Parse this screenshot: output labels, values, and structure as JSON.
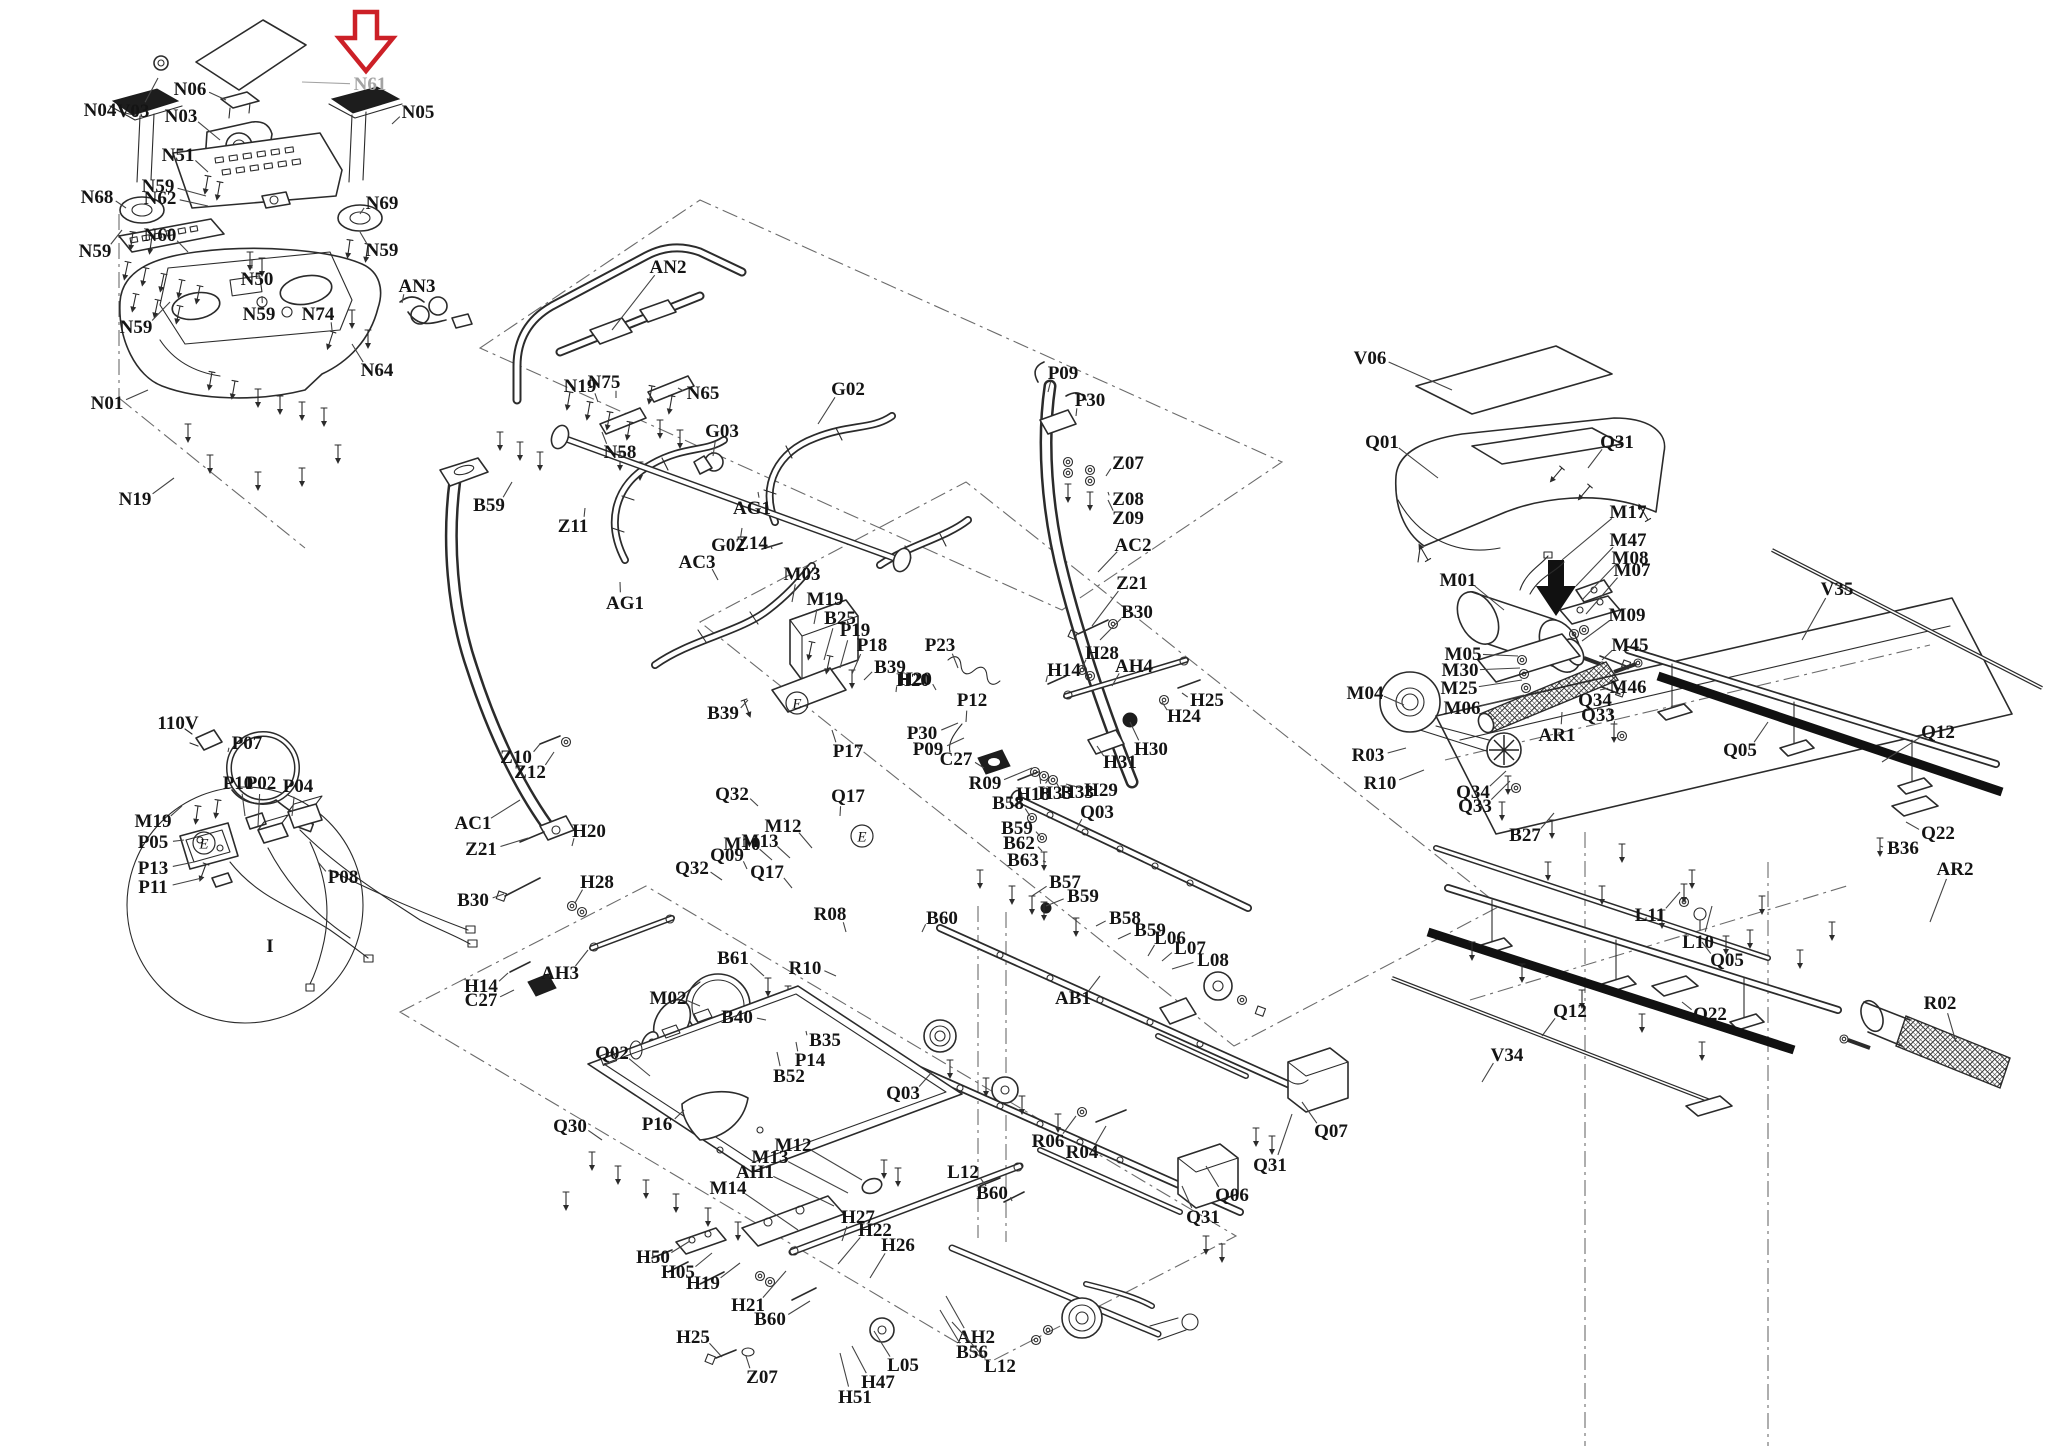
{
  "page": {
    "type": "exploded-parts-diagram",
    "subject": "treadmill-parts-schematic",
    "background": "#ffffff"
  },
  "style": {
    "line": "#2b2b2b",
    "label": "#141414",
    "leader": "#444444",
    "muted_label": "#a3a3a3",
    "highlight": "#cc2027"
  },
  "highlight_arrow": {
    "shape": "down-arrow-outline",
    "target_label": "N61"
  },
  "secondary_arrow": {
    "shape": "down-arrow-solid",
    "color": "#111111"
  },
  "circled_marks": [
    {
      "t": "E",
      "x": 204,
      "y": 843
    },
    {
      "t": "E",
      "x": 797,
      "y": 703
    },
    {
      "t": "E",
      "x": 862,
      "y": 836
    }
  ],
  "labels": [
    {
      "t": "N04",
      "x": 100,
      "y": 110,
      "ex": 138,
      "ey": 116
    },
    {
      "t": "V03",
      "x": 133,
      "y": 111,
      "ex": 158,
      "ey": 78
    },
    {
      "t": "N06",
      "x": 190,
      "y": 89,
      "ex": 226,
      "ey": 100
    },
    {
      "t": "N03",
      "x": 181,
      "y": 116,
      "ex": 220,
      "ey": 140
    },
    {
      "t": "N51",
      "x": 178,
      "y": 155,
      "ex": 208,
      "ey": 172
    },
    {
      "t": "N59",
      "x": 158,
      "y": 186,
      "ex": 206,
      "ey": 196
    },
    {
      "t": "N62",
      "x": 160,
      "y": 198,
      "ex": 208,
      "ey": 206
    },
    {
      "t": "N68",
      "x": 97,
      "y": 197,
      "ex": 126,
      "ey": 208
    },
    {
      "t": "N59",
      "x": 95,
      "y": 251,
      "ex": 122,
      "ey": 230
    },
    {
      "t": "N60",
      "x": 160,
      "y": 235,
      "ex": 188,
      "ey": 252
    },
    {
      "t": "N50",
      "x": 257,
      "y": 279,
      "ex": 252,
      "ey": 260
    },
    {
      "t": "N69",
      "x": 382,
      "y": 203,
      "ex": 360,
      "ey": 214
    },
    {
      "t": "N59",
      "x": 382,
      "y": 250,
      "ex": 360,
      "ey": 232
    },
    {
      "t": "N05",
      "x": 418,
      "y": 112,
      "ex": 392,
      "ey": 124
    },
    {
      "t": "N61",
      "x": 370,
      "y": 84,
      "ex": 302,
      "ey": 82,
      "m": 1
    },
    {
      "t": "AN3",
      "x": 417,
      "y": 286,
      "ex": 402,
      "ey": 303
    },
    {
      "t": "N74",
      "x": 318,
      "y": 314,
      "ex": 332,
      "ey": 330
    },
    {
      "t": "N64",
      "x": 377,
      "y": 370,
      "ex": 352,
      "ey": 344
    },
    {
      "t": "N59",
      "x": 259,
      "y": 314,
      "ex": 262,
      "ey": 296
    },
    {
      "t": "N59",
      "x": 136,
      "y": 327,
      "ex": 170,
      "ey": 302
    },
    {
      "t": "N01",
      "x": 107,
      "y": 403,
      "ex": 148,
      "ey": 390
    },
    {
      "t": "N19",
      "x": 135,
      "y": 499,
      "ex": 174,
      "ey": 478
    },
    {
      "t": "110V",
      "x": 178,
      "y": 723,
      "b": 1
    },
    {
      "t": "P07",
      "x": 247,
      "y": 743,
      "ex": 228,
      "ey": 752
    },
    {
      "t": "P10",
      "x": 238,
      "y": 783,
      "ex": 245,
      "ey": 816
    },
    {
      "t": "P02",
      "x": 261,
      "y": 783,
      "ex": 258,
      "ey": 826
    },
    {
      "t": "P04",
      "x": 298,
      "y": 786,
      "ex": 292,
      "ey": 816
    },
    {
      "t": "M19",
      "x": 153,
      "y": 821,
      "ex": 182,
      "ey": 806
    },
    {
      "t": "P05",
      "x": 153,
      "y": 842,
      "ex": 184,
      "ey": 840
    },
    {
      "t": "P13",
      "x": 153,
      "y": 868,
      "ex": 194,
      "ey": 862
    },
    {
      "t": "P11",
      "x": 153,
      "y": 887,
      "ex": 202,
      "ey": 878
    },
    {
      "t": "P08",
      "x": 343,
      "y": 877,
      "ex": 318,
      "ey": 862
    },
    {
      "t": "I",
      "x": 270,
      "y": 946
    },
    {
      "t": "AN2",
      "x": 668,
      "y": 267,
      "ex": 612,
      "ey": 330
    },
    {
      "t": "N19",
      "x": 580,
      "y": 386,
      "ex": 598,
      "ey": 402
    },
    {
      "t": "N75",
      "x": 604,
      "y": 382,
      "ex": 616,
      "ey": 398
    },
    {
      "t": "N65",
      "x": 703,
      "y": 393,
      "ex": 678,
      "ey": 388
    },
    {
      "t": "N58",
      "x": 620,
      "y": 452,
      "ex": 602,
      "ey": 432
    },
    {
      "t": "G02",
      "x": 848,
      "y": 389,
      "ex": 818,
      "ey": 424
    },
    {
      "t": "G03",
      "x": 722,
      "y": 431,
      "ex": 713,
      "ey": 456
    },
    {
      "t": "AG1",
      "x": 752,
      "y": 508,
      "ex": 758,
      "ey": 492
    },
    {
      "t": "B59",
      "x": 489,
      "y": 505,
      "ex": 512,
      "ey": 482
    },
    {
      "t": "Z11",
      "x": 573,
      "y": 526,
      "ex": 585,
      "ey": 508
    },
    {
      "t": "G02",
      "x": 728,
      "y": 545,
      "ex": 742,
      "ey": 528
    },
    {
      "t": "Z14",
      "x": 752,
      "y": 543,
      "ex": 772,
      "ey": 549
    },
    {
      "t": "AC3",
      "x": 697,
      "y": 562,
      "ex": 718,
      "ey": 580
    },
    {
      "t": "AG1",
      "x": 625,
      "y": 603,
      "ex": 620,
      "ey": 582
    },
    {
      "t": "M03",
      "x": 802,
      "y": 574,
      "ex": 792,
      "ey": 602
    },
    {
      "t": "M19",
      "x": 825,
      "y": 599,
      "ex": 814,
      "ey": 624
    },
    {
      "t": "B25",
      "x": 840,
      "y": 618,
      "ex": 824,
      "ey": 660
    },
    {
      "t": "P19",
      "x": 855,
      "y": 630,
      "ex": 840,
      "ey": 668
    },
    {
      "t": "P18",
      "x": 872,
      "y": 645,
      "ex": 852,
      "ey": 674
    },
    {
      "t": "B39",
      "x": 890,
      "y": 667,
      "ex": 864,
      "ey": 680
    },
    {
      "t": "H20",
      "x": 913,
      "y": 680,
      "ex": 896,
      "ey": 692
    },
    {
      "t": "B39",
      "x": 723,
      "y": 713,
      "ex": 748,
      "ey": 700
    },
    {
      "t": "Z10",
      "x": 516,
      "y": 757,
      "ex": 540,
      "ey": 744
    },
    {
      "t": "Z12",
      "x": 530,
      "y": 772,
      "ex": 554,
      "ey": 752
    },
    {
      "t": "P17",
      "x": 848,
      "y": 751,
      "ex": 832,
      "ey": 730
    },
    {
      "t": "P30",
      "x": 922,
      "y": 733,
      "ex": 958,
      "ey": 723
    },
    {
      "t": "P09",
      "x": 928,
      "y": 749,
      "ex": 964,
      "ey": 738
    },
    {
      "t": "AC1",
      "x": 473,
      "y": 823,
      "ex": 520,
      "ey": 800
    },
    {
      "t": "Z21",
      "x": 481,
      "y": 849,
      "ex": 528,
      "ey": 838
    },
    {
      "t": "H20",
      "x": 589,
      "y": 831,
      "ex": 572,
      "ey": 846
    },
    {
      "t": "B30",
      "x": 473,
      "y": 900,
      "ex": 504,
      "ey": 894
    },
    {
      "t": "H28",
      "x": 597,
      "y": 882,
      "ex": 575,
      "ey": 903
    },
    {
      "t": "AH3",
      "x": 560,
      "y": 973,
      "ex": 588,
      "ey": 950
    },
    {
      "t": "H14",
      "x": 481,
      "y": 986,
      "ex": 508,
      "ey": 973
    },
    {
      "t": "C27",
      "x": 481,
      "y": 1000,
      "ex": 514,
      "ey": 990
    },
    {
      "t": "Q32",
      "x": 732,
      "y": 794,
      "ex": 758,
      "ey": 806
    },
    {
      "t": "Q17",
      "x": 848,
      "y": 796,
      "ex": 840,
      "ey": 816
    },
    {
      "t": "Q32",
      "x": 692,
      "y": 868,
      "ex": 722,
      "ey": 880
    },
    {
      "t": "Q09",
      "x": 727,
      "y": 855,
      "ex": 747,
      "ey": 869
    },
    {
      "t": "M10",
      "x": 742,
      "y": 844,
      "ex": 772,
      "ey": 860
    },
    {
      "t": "M13",
      "x": 760,
      "y": 841,
      "ex": 790,
      "ey": 858
    },
    {
      "t": "M12",
      "x": 783,
      "y": 826,
      "ex": 812,
      "ey": 848
    },
    {
      "t": "Q17",
      "x": 767,
      "y": 872,
      "ex": 792,
      "ey": 888
    },
    {
      "t": "R08",
      "x": 830,
      "y": 914,
      "ex": 846,
      "ey": 932
    },
    {
      "t": "B60",
      "x": 942,
      "y": 918,
      "ex": 922,
      "ey": 932
    },
    {
      "t": "R10",
      "x": 805,
      "y": 968,
      "ex": 836,
      "ey": 976
    },
    {
      "t": "B61",
      "x": 733,
      "y": 958,
      "ex": 764,
      "ey": 976
    },
    {
      "t": "M02",
      "x": 668,
      "y": 998,
      "ex": 700,
      "ey": 1006
    },
    {
      "t": "B40",
      "x": 737,
      "y": 1017,
      "ex": 766,
      "ey": 1020
    },
    {
      "t": "B35",
      "x": 825,
      "y": 1040,
      "ex": 806,
      "ey": 1031
    },
    {
      "t": "P14",
      "x": 810,
      "y": 1060,
      "ex": 796,
      "ey": 1042
    },
    {
      "t": "B52",
      "x": 789,
      "y": 1076,
      "ex": 777,
      "ey": 1052
    },
    {
      "t": "Q02",
      "x": 612,
      "y": 1053,
      "ex": 650,
      "ey": 1076
    },
    {
      "t": "P16",
      "x": 657,
      "y": 1124,
      "ex": 684,
      "ey": 1110
    },
    {
      "t": "Q30",
      "x": 570,
      "y": 1126,
      "ex": 602,
      "ey": 1140
    },
    {
      "t": "Q03",
      "x": 903,
      "y": 1093,
      "ex": 932,
      "ey": 1072
    },
    {
      "t": "P09",
      "x": 1063,
      "y": 373,
      "ex": 1048,
      "ey": 392
    },
    {
      "t": "P30",
      "x": 1090,
      "y": 400,
      "ex": 1076,
      "ey": 416
    },
    {
      "t": "Z07",
      "x": 1128,
      "y": 463,
      "ex": 1106,
      "ey": 476
    },
    {
      "t": "Z08",
      "x": 1128,
      "y": 499,
      "ex": 1108,
      "ey": 492
    },
    {
      "t": "Z09",
      "x": 1128,
      "y": 518,
      "ex": 1108,
      "ey": 500
    },
    {
      "t": "AC2",
      "x": 1133,
      "y": 545,
      "ex": 1098,
      "ey": 572
    },
    {
      "t": "Z21",
      "x": 1132,
      "y": 583,
      "ex": 1092,
      "ey": 626
    },
    {
      "t": "B30",
      "x": 1137,
      "y": 612,
      "ex": 1100,
      "ey": 640
    },
    {
      "t": "H28",
      "x": 1102,
      "y": 653,
      "ex": 1082,
      "ey": 668
    },
    {
      "t": "H14",
      "x": 1064,
      "y": 670,
      "ex": 1046,
      "ey": 682
    },
    {
      "t": "AH4",
      "x": 1134,
      "y": 666,
      "ex": 1112,
      "ey": 686
    },
    {
      "t": "H25",
      "x": 1207,
      "y": 700,
      "ex": 1182,
      "ey": 693
    },
    {
      "t": "H24",
      "x": 1184,
      "y": 716,
      "ex": 1162,
      "ey": 702
    },
    {
      "t": "H30",
      "x": 1151,
      "y": 749,
      "ex": 1130,
      "ey": 722
    },
    {
      "t": "H31",
      "x": 1120,
      "y": 762,
      "ex": 1097,
      "ey": 746
    },
    {
      "t": "P23",
      "x": 940,
      "y": 645,
      "ex": 958,
      "ey": 668
    },
    {
      "t": "H20",
      "x": 915,
      "y": 679,
      "ex": 936,
      "ey": 690
    },
    {
      "t": "P12",
      "x": 972,
      "y": 700,
      "ex": 966,
      "ey": 722
    },
    {
      "t": "C27",
      "x": 956,
      "y": 759,
      "ex": 984,
      "ey": 768
    },
    {
      "t": "R09",
      "x": 985,
      "y": 783,
      "ex": 1032,
      "ey": 768
    },
    {
      "t": "H18",
      "x": 1033,
      "y": 794,
      "ex": 1040,
      "ey": 777
    },
    {
      "t": "H33",
      "x": 1055,
      "y": 793,
      "ex": 1048,
      "ey": 780
    },
    {
      "t": "H33",
      "x": 1077,
      "y": 792,
      "ex": 1056,
      "ey": 782
    },
    {
      "t": "H29",
      "x": 1101,
      "y": 790,
      "ex": 1066,
      "ey": 784
    },
    {
      "t": "B58",
      "x": 1008,
      "y": 803,
      "ex": 1030,
      "ey": 816
    },
    {
      "t": "B59",
      "x": 1017,
      "y": 828,
      "ex": 1040,
      "ey": 836
    },
    {
      "t": "B62",
      "x": 1019,
      "y": 843,
      "ex": 1042,
      "ey": 851
    },
    {
      "t": "B63",
      "x": 1023,
      "y": 860,
      "ex": 1046,
      "ey": 862
    },
    {
      "t": "Q03",
      "x": 1097,
      "y": 812,
      "ex": 1076,
      "ey": 830
    },
    {
      "t": "B57",
      "x": 1065,
      "y": 882,
      "ex": 1032,
      "ey": 896
    },
    {
      "t": "B59",
      "x": 1083,
      "y": 896,
      "ex": 1046,
      "ey": 906
    },
    {
      "t": "B58",
      "x": 1125,
      "y": 918,
      "ex": 1096,
      "ey": 926
    },
    {
      "t": "B59",
      "x": 1150,
      "y": 930,
      "ex": 1118,
      "ey": 939
    },
    {
      "t": "L06",
      "x": 1170,
      "y": 938,
      "ex": 1148,
      "ey": 956
    },
    {
      "t": "L07",
      "x": 1190,
      "y": 948,
      "ex": 1162,
      "ey": 961
    },
    {
      "t": "L08",
      "x": 1213,
      "y": 960,
      "ex": 1172,
      "ey": 969
    },
    {
      "t": "AB1",
      "x": 1073,
      "y": 998,
      "ex": 1100,
      "ey": 976
    },
    {
      "t": "M12",
      "x": 793,
      "y": 1145,
      "ex": 862,
      "ey": 1180
    },
    {
      "t": "M13",
      "x": 770,
      "y": 1157,
      "ex": 848,
      "ey": 1193
    },
    {
      "t": "AH1",
      "x": 755,
      "y": 1172,
      "ex": 834,
      "ey": 1206
    },
    {
      "t": "M14",
      "x": 728,
      "y": 1188,
      "ex": 798,
      "ey": 1230
    },
    {
      "t": "H27",
      "x": 858,
      "y": 1217,
      "ex": 842,
      "ey": 1241
    },
    {
      "t": "H22",
      "x": 875,
      "y": 1230,
      "ex": 838,
      "ey": 1264
    },
    {
      "t": "H26",
      "x": 898,
      "y": 1245,
      "ex": 870,
      "ey": 1278
    },
    {
      "t": "H50",
      "x": 653,
      "y": 1257,
      "ex": 690,
      "ey": 1241
    },
    {
      "t": "H05",
      "x": 678,
      "y": 1272,
      "ex": 712,
      "ey": 1253
    },
    {
      "t": "H19",
      "x": 703,
      "y": 1283,
      "ex": 740,
      "ey": 1263
    },
    {
      "t": "H21",
      "x": 748,
      "y": 1305,
      "ex": 786,
      "ey": 1271
    },
    {
      "t": "B60",
      "x": 770,
      "y": 1319,
      "ex": 810,
      "ey": 1301
    },
    {
      "t": "H25",
      "x": 693,
      "y": 1337,
      "ex": 722,
      "ey": 1357
    },
    {
      "t": "Z07",
      "x": 762,
      "y": 1377,
      "ex": 746,
      "ey": 1356
    },
    {
      "t": "L05",
      "x": 903,
      "y": 1365,
      "ex": 874,
      "ey": 1331
    },
    {
      "t": "H47",
      "x": 878,
      "y": 1382,
      "ex": 852,
      "ey": 1346
    },
    {
      "t": "H51",
      "x": 855,
      "y": 1397,
      "ex": 840,
      "ey": 1353
    },
    {
      "t": "AH2",
      "x": 976,
      "y": 1337,
      "ex": 946,
      "ey": 1296
    },
    {
      "t": "B56",
      "x": 972,
      "y": 1352,
      "ex": 940,
      "ey": 1310
    },
    {
      "t": "L12",
      "x": 1000,
      "y": 1366,
      "ex": 952,
      "ey": 1322
    },
    {
      "t": "L12",
      "x": 963,
      "y": 1172,
      "ex": 986,
      "ey": 1186
    },
    {
      "t": "B60",
      "x": 992,
      "y": 1193,
      "ex": 1012,
      "ey": 1201
    },
    {
      "t": "R06",
      "x": 1048,
      "y": 1141,
      "ex": 1076,
      "ey": 1116
    },
    {
      "t": "R04",
      "x": 1082,
      "y": 1152,
      "ex": 1106,
      "ey": 1126
    },
    {
      "t": "Q07",
      "x": 1331,
      "y": 1131,
      "ex": 1302,
      "ey": 1102
    },
    {
      "t": "Q31",
      "x": 1270,
      "y": 1165,
      "ex": 1292,
      "ey": 1114
    },
    {
      "t": "Q06",
      "x": 1232,
      "y": 1195,
      "ex": 1206,
      "ey": 1166
    },
    {
      "t": "Q31",
      "x": 1203,
      "y": 1217,
      "ex": 1182,
      "ey": 1186
    },
    {
      "t": "V06",
      "x": 1370,
      "y": 358,
      "ex": 1452,
      "ey": 390
    },
    {
      "t": "Q01",
      "x": 1382,
      "y": 442,
      "ex": 1438,
      "ey": 478
    },
    {
      "t": "Q31",
      "x": 1617,
      "y": 442,
      "ex": 1588,
      "ey": 468
    },
    {
      "t": "M17",
      "x": 1628,
      "y": 512,
      "ex": 1562,
      "ey": 560
    },
    {
      "t": "M47",
      "x": 1628,
      "y": 540,
      "ex": 1576,
      "ey": 586
    },
    {
      "t": "M08",
      "x": 1630,
      "y": 558,
      "ex": 1582,
      "ey": 600
    },
    {
      "t": "M07",
      "x": 1632,
      "y": 570,
      "ex": 1586,
      "ey": 614
    },
    {
      "t": "M01",
      "x": 1458,
      "y": 580,
      "ex": 1504,
      "ey": 610
    },
    {
      "t": "M09",
      "x": 1627,
      "y": 615,
      "ex": 1582,
      "ey": 641
    },
    {
      "t": "M45",
      "x": 1630,
      "y": 645,
      "ex": 1602,
      "ey": 660
    },
    {
      "t": "M05",
      "x": 1463,
      "y": 654,
      "ex": 1518,
      "ey": 656
    },
    {
      "t": "M30",
      "x": 1460,
      "y": 670,
      "ex": 1520,
      "ey": 668
    },
    {
      "t": "M25",
      "x": 1459,
      "y": 688,
      "ex": 1522,
      "ey": 680
    },
    {
      "t": "M06",
      "x": 1462,
      "y": 708,
      "ex": 1524,
      "ey": 695
    },
    {
      "t": "M46",
      "x": 1628,
      "y": 687,
      "ex": 1600,
      "ey": 690
    },
    {
      "t": "M04",
      "x": 1365,
      "y": 693,
      "ex": 1404,
      "ey": 705
    },
    {
      "t": "AR1",
      "x": 1557,
      "y": 735,
      "ex": 1562,
      "ey": 712
    },
    {
      "t": "Q34",
      "x": 1595,
      "y": 700,
      "ex": 1612,
      "ey": 718
    },
    {
      "t": "Q33",
      "x": 1598,
      "y": 715,
      "ex": 1614,
      "ey": 726
    },
    {
      "t": "R03",
      "x": 1368,
      "y": 755,
      "ex": 1406,
      "ey": 748
    },
    {
      "t": "R10",
      "x": 1380,
      "y": 783,
      "ex": 1424,
      "ey": 770
    },
    {
      "t": "Q34",
      "x": 1473,
      "y": 792,
      "ex": 1506,
      "ey": 771
    },
    {
      "t": "Q33",
      "x": 1475,
      "y": 806,
      "ex": 1510,
      "ey": 781
    },
    {
      "t": "B27",
      "x": 1525,
      "y": 835,
      "ex": 1554,
      "ey": 813
    },
    {
      "t": "V35",
      "x": 1837,
      "y": 589,
      "ex": 1802,
      "ey": 640
    },
    {
      "t": "Q12",
      "x": 1938,
      "y": 732,
      "ex": 1882,
      "ey": 762
    },
    {
      "t": "Q05",
      "x": 1740,
      "y": 750,
      "ex": 1768,
      "ey": 722
    },
    {
      "t": "Q22",
      "x": 1938,
      "y": 833,
      "ex": 1906,
      "ey": 822
    },
    {
      "t": "B36",
      "x": 1903,
      "y": 848,
      "ex": 1880,
      "ey": 846
    },
    {
      "t": "AR2",
      "x": 1955,
      "y": 869,
      "ex": 1930,
      "ey": 922
    },
    {
      "t": "L11",
      "x": 1650,
      "y": 915,
      "ex": 1680,
      "ey": 892
    },
    {
      "t": "L10",
      "x": 1698,
      "y": 942,
      "ex": 1712,
      "ey": 906
    },
    {
      "t": "Q05",
      "x": 1727,
      "y": 960,
      "ex": 1702,
      "ey": 942
    },
    {
      "t": "Q22",
      "x": 1710,
      "y": 1014,
      "ex": 1682,
      "ey": 1002
    },
    {
      "t": "R02",
      "x": 1940,
      "y": 1003,
      "ex": 1956,
      "ey": 1042
    },
    {
      "t": "Q12",
      "x": 1570,
      "y": 1011,
      "ex": 1542,
      "ey": 1036
    },
    {
      "t": "V34",
      "x": 1507,
      "y": 1055,
      "ex": 1482,
      "ey": 1082
    }
  ]
}
